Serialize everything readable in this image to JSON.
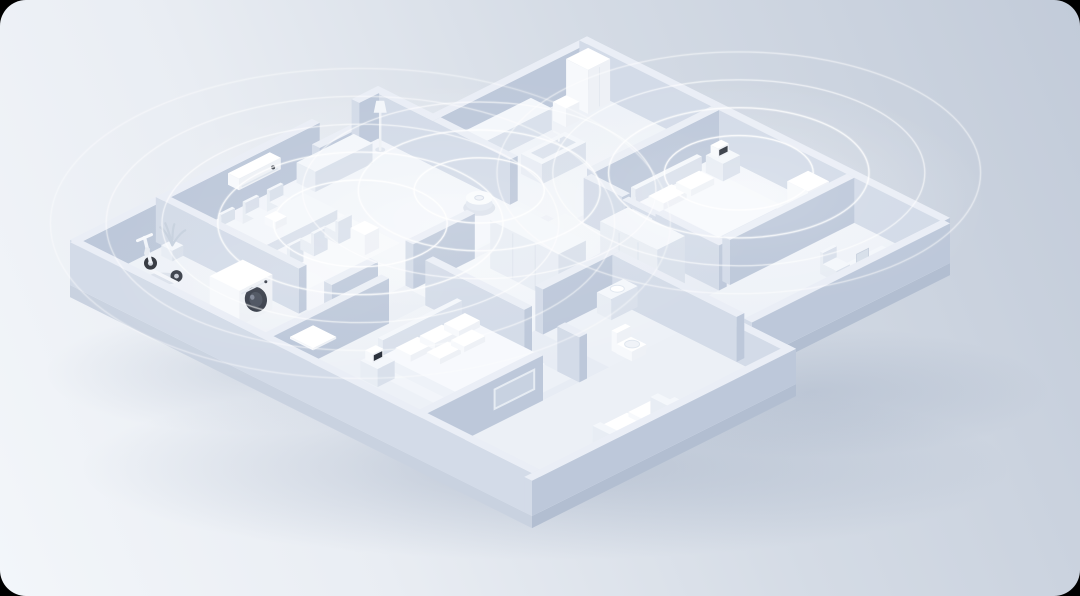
{
  "meta": {
    "description": "Isometric 3D rendering of a smart home apartment floor plan with connected devices and concentric wireless signal coverage waves",
    "frame_color": "#000000",
    "corner_radius": 26
  },
  "palette": {
    "bg_gradient": [
      "#f3f6fa",
      "#e9edf3",
      "#d4dbe5",
      "#c2cbd9"
    ],
    "wall": {
      "t": "#eaeef6",
      "l": "#d3dbe8",
      "r": "#bdc8da"
    },
    "furn": {
      "t": "#f4f7fb",
      "l": "#e8edf4",
      "r": "#d9e0eb"
    },
    "dev": {
      "t": "#ffffff",
      "l": "#f7f9fc",
      "r": "#eef1f6"
    },
    "bed": {
      "t": "#f7f9fd",
      "l": "#eef2f8",
      "r": "#e3e9f2"
    },
    "slab_l": "#c9d2e0",
    "slab_r": "#b2bed1",
    "floor_base": "#e7ecf4",
    "dark_accent": "#333945",
    "screen_dark": "#2b313b",
    "wave_stroke": "#ffffff",
    "shadow_color": "#6c80a0"
  },
  "scene": {
    "projection": {
      "ox": 70,
      "oy": 285,
      "ux": 22,
      "uy": 11,
      "uz": 22
    },
    "footprint": [
      [
        0,
        0
      ],
      [
        14,
        0
      ],
      [
        14,
        2.5
      ],
      [
        21,
        2.5
      ],
      [
        21,
        19
      ],
      [
        12,
        19
      ],
      [
        12,
        21
      ],
      [
        0,
        21
      ]
    ],
    "slab": {
      "depth": 0.55,
      "edges": [
        {
          "from": [
            0,
            0
          ],
          "to": [
            0,
            21
          ],
          "side": "l"
        },
        {
          "from": [
            0,
            21
          ],
          "to": [
            12,
            21
          ],
          "side": "r"
        },
        {
          "from": [
            12,
            19
          ],
          "to": [
            21,
            19
          ],
          "side": "r"
        }
      ]
    },
    "floors": [
      {
        "n": "floor-entry",
        "a": 0.35,
        "b": 0.35,
        "da": 3.55,
        "db": 8.3,
        "f": "#edf1f7"
      },
      {
        "n": "floor-living",
        "a": 4.25,
        "b": 0.35,
        "da": 9.75,
        "db": 7.3,
        "f": "#eff3f9"
      },
      {
        "n": "rug-living",
        "a": 4.8,
        "b": 1.3,
        "da": 4.6,
        "db": 4.3,
        "f": "#f4f7fb"
      },
      {
        "n": "floor-kitchen",
        "a": 14,
        "b": 2.85,
        "da": 6.65,
        "db": 5.65,
        "f": "#eef2f8"
      },
      {
        "n": "floor-master",
        "a": 14.85,
        "b": 8.85,
        "da": 5.8,
        "db": 5.8,
        "f": "#eff3f9"
      },
      {
        "n": "rug-master",
        "a": 15.4,
        "b": 9.4,
        "da": 4.4,
        "db": 4.2,
        "f": "#f3f6fb"
      },
      {
        "n": "floor-bedroom",
        "a": 0.35,
        "b": 9,
        "da": 6.8,
        "db": 6.65,
        "f": "#edf1f7"
      },
      {
        "n": "rug-bedroom",
        "a": 2.9,
        "b": 10.3,
        "da": 4.3,
        "db": 4.1,
        "f": "#f2f5fa"
      },
      {
        "n": "floor-corridor",
        "a": 7.5,
        "b": 8,
        "da": 7,
        "db": 4.65,
        "f": "#f0f4f9"
      },
      {
        "n": "floor-bathroom",
        "a": 8.5,
        "b": 13,
        "da": 3.15,
        "db": 5.65,
        "f": "#edf1f7"
      },
      {
        "n": "floor-study",
        "a": 12,
        "b": 15,
        "da": 8.65,
        "db": 3.65,
        "f": "#eef2f8"
      },
      {
        "n": "floor-family",
        "a": 0.35,
        "b": 16,
        "da": 11.3,
        "db": 4.65,
        "f": "#ecf0f6"
      }
    ],
    "draw": [
      {
        "t": "wall",
        "n": "outer-wall-top-right",
        "a": 13.65,
        "b": 2.5,
        "da": 7.35,
        "db": 0.35,
        "h": 2.05
      },
      {
        "t": "wall",
        "n": "outer-wall-notch",
        "a": 13.65,
        "b": 0,
        "da": 0.35,
        "db": 2.85,
        "h": 2.05
      },
      {
        "t": "wall",
        "n": "outer-wall-top-a",
        "a": 0,
        "b": 0,
        "da": 11,
        "db": 0.35,
        "h": 2.05
      },
      {
        "t": "wall",
        "n": "window-sill-wall",
        "a": 11,
        "b": 0,
        "da": 1.8,
        "db": 0.35,
        "h": 0.9
      },
      {
        "t": "wall",
        "n": "outer-wall-top-b",
        "a": 12.8,
        "b": 0,
        "da": 0.9,
        "db": 0.35,
        "h": 2.05
      },
      {
        "t": "ac",
        "n": "air-conditioner",
        "a": 6.8,
        "b": 0.38,
        "da": 1.9,
        "db": 0.5,
        "h": 0.52,
        "z0": 1.35
      },
      {
        "t": "wall",
        "n": "outer-wall-right",
        "a": 20.65,
        "b": 2.5,
        "da": 0.35,
        "db": 16.5,
        "h": 2.05
      },
      {
        "t": "fridge",
        "n": "refrigerator",
        "a": 19.55,
        "b": 3.0,
        "da": 1.0,
        "db": 1.0,
        "h": 2.0
      },
      {
        "t": "box",
        "pal": "furn",
        "n": "kitchen-counter",
        "a": 14.6,
        "b": 2.95,
        "da": 3.4,
        "db": 0.95,
        "h": 0.98
      },
      {
        "t": "sink",
        "n": "kitchen-island",
        "a": 15.3,
        "b": 5.2,
        "da": 2.0,
        "db": 0.95,
        "h": 0.92
      },
      {
        "t": "box",
        "pal": "dev",
        "n": "water-purifier",
        "a": 18.45,
        "b": 3.5,
        "da": 0.6,
        "db": 0.6,
        "h": 0.85
      },
      {
        "t": "wall",
        "n": "kitchen-divider-wall",
        "a": 13.65,
        "b": 2.85,
        "da": 0.35,
        "db": 3.5,
        "h": 2.05
      },
      {
        "t": "lamp",
        "n": "floor-lamp",
        "a": 13.2,
        "b": 0.9
      },
      {
        "t": "box",
        "pal": "furn",
        "n": "sideboard",
        "a": 9.8,
        "b": 0.5,
        "da": 2.6,
        "db": 0.85,
        "h": 0.92
      },
      {
        "t": "chair",
        "n": "dining-chair-1",
        "a": 5.6,
        "b": 1.15,
        "facing": "far"
      },
      {
        "t": "chair",
        "n": "dining-chair-2",
        "a": 6.7,
        "b": 1.15,
        "facing": "far"
      },
      {
        "t": "chair",
        "n": "dining-chair-3",
        "a": 7.8,
        "b": 1.15,
        "facing": "far"
      },
      {
        "t": "box",
        "pal": "furn",
        "n": "dining-table",
        "a": 5.3,
        "b": 1.95,
        "da": 3.4,
        "db": 1.5,
        "h": 0.8
      },
      {
        "t": "box",
        "pal": "dev",
        "n": "kettle",
        "a": 6.4,
        "b": 2.45,
        "da": 0.5,
        "db": 0.5,
        "h": 0.34,
        "z0": 0.8
      },
      {
        "t": "chair",
        "n": "dining-chair-4",
        "a": 5.75,
        "b": 3.62,
        "facing": "near"
      },
      {
        "t": "chair",
        "n": "dining-chair-5",
        "a": 6.85,
        "b": 3.62,
        "facing": "near"
      },
      {
        "t": "chair",
        "n": "dining-chair-6",
        "a": 7.95,
        "b": 3.62,
        "facing": "near"
      },
      {
        "t": "box",
        "pal": "dev",
        "n": "smart-speaker",
        "a": 8.05,
        "b": 4.7,
        "da": 0.65,
        "db": 0.65,
        "h": 0.92
      },
      {
        "t": "vacuum",
        "n": "robot-vacuum",
        "a": 12.9,
        "b": 5.7
      },
      {
        "t": "wall",
        "n": "living-wall-a",
        "a": 3.9,
        "b": 7.65,
        "da": 2.1,
        "db": 0.35,
        "h": 2.05
      },
      {
        "t": "wall",
        "n": "living-wall-b",
        "a": 7.6,
        "b": 7.65,
        "da": 2.8,
        "db": 0.35,
        "h": 2.05
      },
      {
        "t": "wall",
        "n": "master-wall-top",
        "a": 15,
        "b": 8.5,
        "da": 5.65,
        "db": 0.35,
        "h": 2.05
      },
      {
        "t": "box",
        "pal": "furn",
        "n": "master-headboard",
        "a": 16,
        "b": 9.5,
        "da": 3.0,
        "db": 0.22,
        "h": 1.2
      },
      {
        "t": "box",
        "pal": "bed",
        "n": "master-bed",
        "a": 16,
        "b": 9.72,
        "da": 3.0,
        "db": 3.4,
        "h": 0.55
      },
      {
        "t": "box",
        "pal": "dev",
        "n": "master-pillow-1",
        "a": 16.35,
        "b": 9.95,
        "da": 1.05,
        "db": 0.68,
        "h": 0.3,
        "z0": 0.55
      },
      {
        "t": "box",
        "pal": "dev",
        "n": "master-pillow-2",
        "a": 17.6,
        "b": 9.95,
        "da": 1.05,
        "db": 0.68,
        "h": 0.3,
        "z0": 0.55
      },
      {
        "t": "box",
        "pal": "furn",
        "n": "nightstand-master",
        "a": 19.55,
        "b": 9.35,
        "da": 0.78,
        "db": 0.78,
        "h": 0.8
      },
      {
        "t": "clock",
        "n": "smart-clock-master",
        "a": 19.7,
        "b": 9.42,
        "z0": 0.8
      },
      {
        "t": "purifier",
        "n": "humidifier",
        "a": 15.45,
        "b": 11.25,
        "da": 0.6,
        "db": 0.6,
        "h": 0.82
      },
      {
        "t": "purifier",
        "n": "air-purifier",
        "a": 19.1,
        "b": 13.5,
        "da": 0.95,
        "db": 0.95,
        "h": 1.92
      },
      {
        "t": "wall",
        "n": "master-wall-left-a",
        "a": 14.5,
        "b": 8.85,
        "da": 0.35,
        "db": 1.75,
        "h": 2.05
      },
      {
        "t": "box",
        "pal": "wall",
        "n": "door-frame-post-1",
        "a": 14.5,
        "b": 10.6,
        "da": 0.3,
        "db": 0.16,
        "h": 1.92
      },
      {
        "t": "box",
        "pal": "wall",
        "n": "door-frame-post-2",
        "a": 14.5,
        "b": 11.96,
        "da": 0.3,
        "db": 0.16,
        "h": 1.92
      },
      {
        "t": "box",
        "pal": "wall",
        "n": "door-frame-lintel",
        "a": 14.5,
        "b": 10.6,
        "da": 0.3,
        "db": 1.52,
        "h": 0.16,
        "z0": 1.76
      },
      {
        "t": "wall",
        "n": "master-wall-left-b",
        "a": 14.5,
        "b": 12.12,
        "da": 0.35,
        "db": 2.88,
        "h": 2.05
      },
      {
        "t": "wall",
        "n": "master-wall-bottom",
        "a": 15,
        "b": 14.65,
        "da": 5.65,
        "db": 0.35,
        "h": 2.05
      },
      {
        "t": "desk",
        "n": "desk",
        "a": 16.9,
        "b": 17.7
      },
      {
        "t": "laptop",
        "n": "laptop",
        "a": 17.75,
        "b": 17.95,
        "z0": 1.06
      },
      {
        "t": "chair",
        "n": "desk-chair",
        "a": 17.55,
        "b": 16.55,
        "facing": "far"
      },
      {
        "t": "wall",
        "n": "outer-wall-bottom-right",
        "a": 12,
        "b": 18.65,
        "da": 9,
        "db": 0.35,
        "h": 1.8
      },
      {
        "t": "wall",
        "n": "outer-wall-step",
        "a": 11.65,
        "b": 18.65,
        "da": 0.35,
        "db": 2.35,
        "h": 1.6
      },
      {
        "t": "wardrobe",
        "n": "wardrobe-1",
        "a": 10.3,
        "b": 8.8,
        "da": 1.25,
        "db": 3.1,
        "h": 2.2
      },
      {
        "t": "wardrobe",
        "n": "wardrobe-2",
        "a": 12.75,
        "b": 11.35,
        "da": 1.25,
        "db": 2.6,
        "h": 2.2
      },
      {
        "t": "wall",
        "n": "bedroom-wall-top",
        "a": 0,
        "b": 8.65,
        "da": 5.5,
        "db": 0.35,
        "h": 2.05
      },
      {
        "t": "wall",
        "n": "bathroom-wall-top",
        "a": 8.5,
        "b": 12.65,
        "da": 3.5,
        "db": 0.35,
        "h": 2.05
      },
      {
        "t": "wall",
        "n": "bathroom-wall-right",
        "a": 11.65,
        "b": 13,
        "da": 0.35,
        "db": 5.65,
        "h": 2.05
      },
      {
        "t": "vanity",
        "n": "bathroom-vanity",
        "a": 10.7,
        "b": 13.25,
        "da": 1.2,
        "db": 0.65,
        "h": 0.95
      },
      {
        "t": "toilet",
        "n": "toilet",
        "a": 9.3,
        "b": 15.3
      },
      {
        "t": "wall",
        "n": "bedroom-wall-right-a",
        "a": 7.15,
        "b": 9,
        "da": 0.35,
        "db": 4.5,
        "h": 2.05
      },
      {
        "t": "wall",
        "n": "bedroom-wall-right-b",
        "a": 7.15,
        "b": 15,
        "da": 0.35,
        "db": 1.0,
        "h": 2.05
      },
      {
        "t": "box",
        "pal": "furn",
        "n": "bed-headboard",
        "a": 3.4,
        "b": 10.6,
        "da": 3.6,
        "db": 0.22,
        "h": 1.2
      },
      {
        "t": "box",
        "pal": "bed",
        "n": "bed",
        "a": 3.4,
        "b": 10.82,
        "da": 3.6,
        "db": 3.3,
        "h": 0.5
      },
      {
        "t": "box",
        "pal": "dev",
        "n": "pillow-1",
        "a": 3.75,
        "b": 11.05,
        "da": 1.0,
        "db": 0.68,
        "h": 0.3,
        "z0": 0.5
      },
      {
        "t": "box",
        "pal": "dev",
        "n": "pillow-2",
        "a": 4.85,
        "b": 11.05,
        "da": 1.0,
        "db": 0.68,
        "h": 0.3,
        "z0": 0.5
      },
      {
        "t": "box",
        "pal": "dev",
        "n": "pillow-3",
        "a": 5.95,
        "b": 11.05,
        "da": 0.95,
        "db": 0.68,
        "h": 0.3,
        "z0": 0.5
      },
      {
        "t": "box",
        "pal": "dev",
        "n": "pillow-4",
        "a": 4.3,
        "b": 11.92,
        "da": 0.95,
        "db": 0.6,
        "h": 0.26,
        "z0": 0.5
      },
      {
        "t": "box",
        "pal": "dev",
        "n": "pillow-5",
        "a": 5.4,
        "b": 11.92,
        "da": 0.95,
        "db": 0.6,
        "h": 0.26,
        "z0": 0.5
      },
      {
        "t": "box",
        "pal": "furn",
        "n": "nightstand-2",
        "a": 2.35,
        "b": 10.85,
        "da": 0.78,
        "db": 0.78,
        "h": 0.82
      },
      {
        "t": "clock",
        "n": "smart-clock-2",
        "a": 2.5,
        "b": 10.92,
        "z0": 0.82
      },
      {
        "t": "wall",
        "n": "family-wall",
        "a": 0,
        "b": 15.65,
        "da": 5.5,
        "db": 0.35,
        "h": 2.05
      },
      {
        "t": "tvframe",
        "n": "tv-frame",
        "a": 3.3,
        "a2": 5.1,
        "b": 16.0,
        "z0": 0.72,
        "z1": 1.6
      },
      {
        "t": "sofa",
        "n": "sofa",
        "a": 4.5,
        "b": 19.3
      },
      {
        "t": "wall",
        "n": "entry-wall",
        "a": 3.9,
        "b": 0,
        "da": 0.35,
        "db": 6.5,
        "h": 2.05
      },
      {
        "t": "plant",
        "n": "potted-plant",
        "a": 3.4,
        "b": 0.75
      },
      {
        "t": "scooter",
        "n": "self-balancing-scooter",
        "a": 2.55,
        "b": 1.7
      },
      {
        "t": "washer",
        "n": "washing-machine",
        "a": 2.0,
        "b": 4.35,
        "da": 1.5,
        "db": 1.35,
        "h": 1.58
      },
      {
        "t": "box",
        "pal": "dev",
        "n": "body-scale",
        "a": 2.55,
        "b": 7.45,
        "da": 1.05,
        "db": 1.05,
        "h": 0.1
      },
      {
        "t": "wall",
        "n": "outer-wall-left",
        "a": 0,
        "b": 0,
        "da": 0.35,
        "db": 21,
        "h": 1.95
      },
      {
        "t": "wall",
        "n": "outer-wall-front",
        "a": 0,
        "b": 20.65,
        "da": 12,
        "db": 0.35,
        "h": 1.6
      }
    ],
    "waves": [
      {
        "n": "living-room-coverage",
        "a": 8.3,
        "b": 4.9,
        "z": 1.1,
        "rings": [
          2.8,
          4.6,
          6.4,
          8.2,
          10.0
        ]
      },
      {
        "n": "vacuum-coverage",
        "a": 12.9,
        "b": 5.7,
        "z": 0.7,
        "rings": [
          2.1,
          3.9,
          5.7
        ]
      },
      {
        "n": "master-bedroom-coverage",
        "a": 19.2,
        "b": 11.2,
        "z": 1.1,
        "rings": [
          2.4,
          4.2,
          6.0,
          7.8
        ]
      }
    ],
    "glows": [
      {
        "a": 11,
        "b": 6,
        "rx": 330,
        "ry": 150,
        "op": 0.5
      },
      {
        "a": 19,
        "b": 11.5,
        "rx": 250,
        "ry": 120,
        "op": 0.45
      },
      {
        "a": 5,
        "b": 5,
        "rx": 215,
        "ry": 100,
        "op": 0.32
      }
    ],
    "shadows": [
      {
        "cx": 545,
        "cy": 468,
        "rx": 465,
        "ry": 92,
        "op": 1
      },
      {
        "cx": 810,
        "cy": 392,
        "rx": 240,
        "ry": 66,
        "op": 0.7
      },
      {
        "cx": 255,
        "cy": 372,
        "rx": 210,
        "ry": 62,
        "op": 0.6
      }
    ]
  }
}
